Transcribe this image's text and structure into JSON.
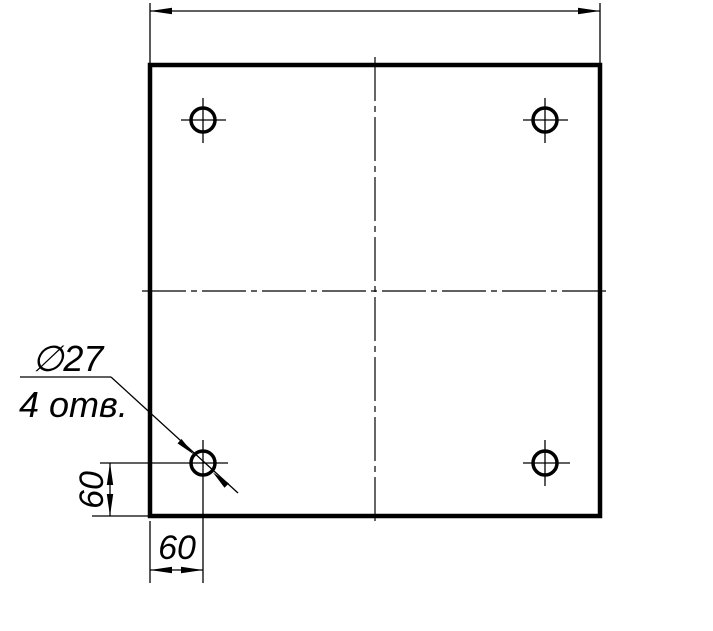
{
  "drawing": {
    "type": "engineering-drawing",
    "background_color": "#ffffff",
    "line_color": "#000000",
    "part": {
      "shape": "square plate",
      "holes": {
        "count": 4,
        "diameter": 27
      }
    },
    "leader_note": {
      "line1": "∅27",
      "line2": "4 отв."
    },
    "dimensions": {
      "hole_offset_horizontal": "60",
      "hole_offset_vertical": "60",
      "overall_width_label": ""
    }
  }
}
